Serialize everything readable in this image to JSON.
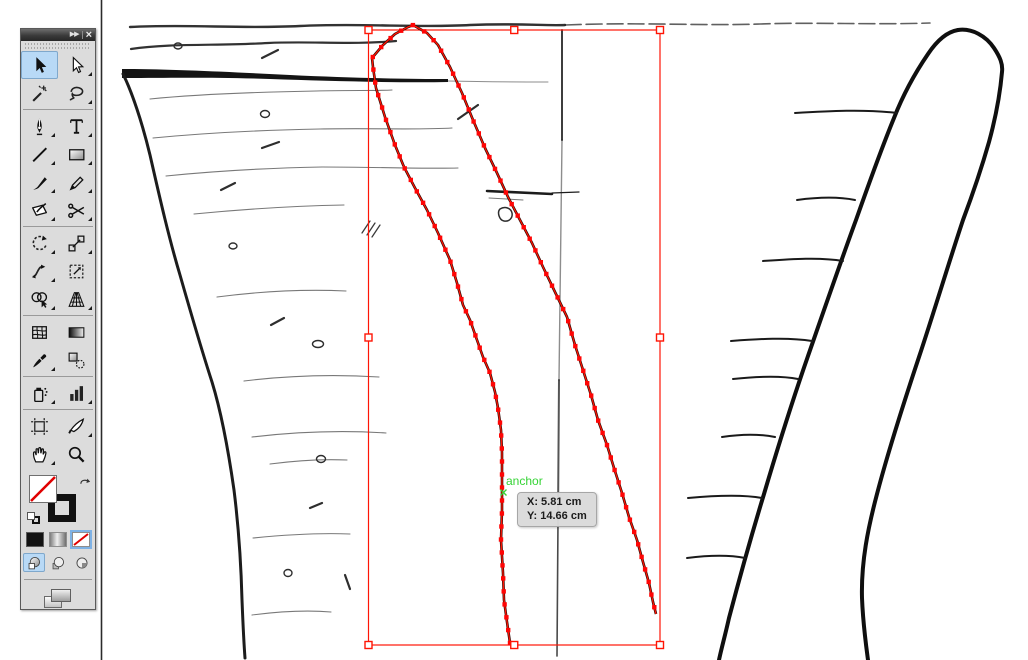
{
  "app": {
    "name": "vector-drawing-application",
    "canvas_units": "cm"
  },
  "smart_guide": {
    "label": "anchor",
    "color": "#35d335"
  },
  "tooltip": {
    "x_text": "X: 5.81 cm",
    "y_text": "Y: 14.66 cm"
  },
  "toolbar": {
    "collapse_glyph": "▶▶",
    "close_glyph": "×",
    "active_tool": "selection-tool",
    "tools": [
      {
        "name": "selection-tool",
        "active": true
      },
      {
        "name": "direct-selection-tool",
        "flyout": true
      },
      {
        "name": "magic-wand-tool"
      },
      {
        "name": "lasso-tool",
        "flyout": true,
        "divider_after": true
      },
      {
        "name": "pen-tool",
        "flyout": true
      },
      {
        "name": "type-tool",
        "flyout": true
      },
      {
        "name": "line-tool",
        "flyout": true
      },
      {
        "name": "rectangle-tool",
        "flyout": true
      },
      {
        "name": "paintbrush-tool",
        "flyout": true
      },
      {
        "name": "pencil-tool",
        "flyout": true
      },
      {
        "name": "blob-brush-tool",
        "flyout": true
      },
      {
        "name": "scissors-tool",
        "flyout": true,
        "divider_after": true
      },
      {
        "name": "rotate-tool",
        "flyout": true
      },
      {
        "name": "scale-tool",
        "flyout": true
      },
      {
        "name": "width-tool",
        "flyout": true
      },
      {
        "name": "free-transform-tool"
      },
      {
        "name": "shape-builder-tool",
        "flyout": true
      },
      {
        "name": "perspective-grid-tool",
        "flyout": true,
        "divider_after": true
      },
      {
        "name": "mesh-tool"
      },
      {
        "name": "gradient-tool"
      },
      {
        "name": "eyedropper-tool",
        "flyout": true
      },
      {
        "name": "blend-tool",
        "divider_after": true
      },
      {
        "name": "symbol-sprayer-tool",
        "flyout": true
      },
      {
        "name": "column-graph-tool",
        "flyout": true,
        "divider_after": true
      },
      {
        "name": "artboard-tool"
      },
      {
        "name": "slice-tool",
        "flyout": true
      },
      {
        "name": "hand-tool",
        "flyout": true
      },
      {
        "name": "zoom-tool"
      }
    ],
    "appearance": {
      "fill": "none",
      "stroke": "black",
      "active_color_type": "none",
      "active_draw_mode": "draw-normal"
    }
  },
  "selection": {
    "stroke_color": "#ff1505",
    "anchor_fill": "#ff0505",
    "anchor_size": 4.4,
    "anchor_spacing": 13,
    "bbox": {
      "x": 368.5,
      "y": 30,
      "w": 291.5,
      "h": 615
    },
    "hover_anchor": {
      "x": 503.5,
      "y": 492.5
    },
    "path": [
      [
        510,
        643
      ],
      [
        507,
        622
      ],
      [
        504,
        600
      ],
      [
        503,
        573
      ],
      [
        501,
        540
      ],
      [
        502,
        510
      ],
      [
        502,
        480
      ],
      [
        502,
        453
      ],
      [
        501,
        430
      ],
      [
        498,
        408
      ],
      [
        495,
        392
      ],
      [
        490,
        373
      ],
      [
        483,
        357
      ],
      [
        477,
        340
      ],
      [
        470,
        320
      ],
      [
        463,
        305
      ],
      [
        457,
        283
      ],
      [
        450,
        260
      ],
      [
        438,
        233
      ],
      [
        427,
        210
      ],
      [
        415,
        188
      ],
      [
        404,
        167
      ],
      [
        395,
        145
      ],
      [
        385,
        117
      ],
      [
        376,
        88
      ],
      [
        373,
        67
      ],
      [
        372,
        58
      ],
      [
        383,
        45
      ],
      [
        395,
        34
      ],
      [
        408,
        27
      ],
      [
        413,
        25
      ],
      [
        427,
        33
      ],
      [
        438,
        45
      ],
      [
        450,
        67
      ],
      [
        462,
        93
      ],
      [
        473,
        120
      ],
      [
        485,
        148
      ],
      [
        497,
        173
      ],
      [
        508,
        197
      ],
      [
        520,
        220
      ],
      [
        532,
        243
      ],
      [
        543,
        267
      ],
      [
        555,
        292
      ],
      [
        567,
        317
      ],
      [
        575,
        345
      ],
      [
        583,
        370
      ],
      [
        591,
        395
      ],
      [
        598,
        420
      ],
      [
        607,
        445
      ],
      [
        614,
        468
      ],
      [
        622,
        493
      ],
      [
        629,
        517
      ],
      [
        637,
        540
      ],
      [
        643,
        562
      ],
      [
        649,
        583
      ],
      [
        653,
        602
      ],
      [
        656,
        614
      ]
    ]
  }
}
